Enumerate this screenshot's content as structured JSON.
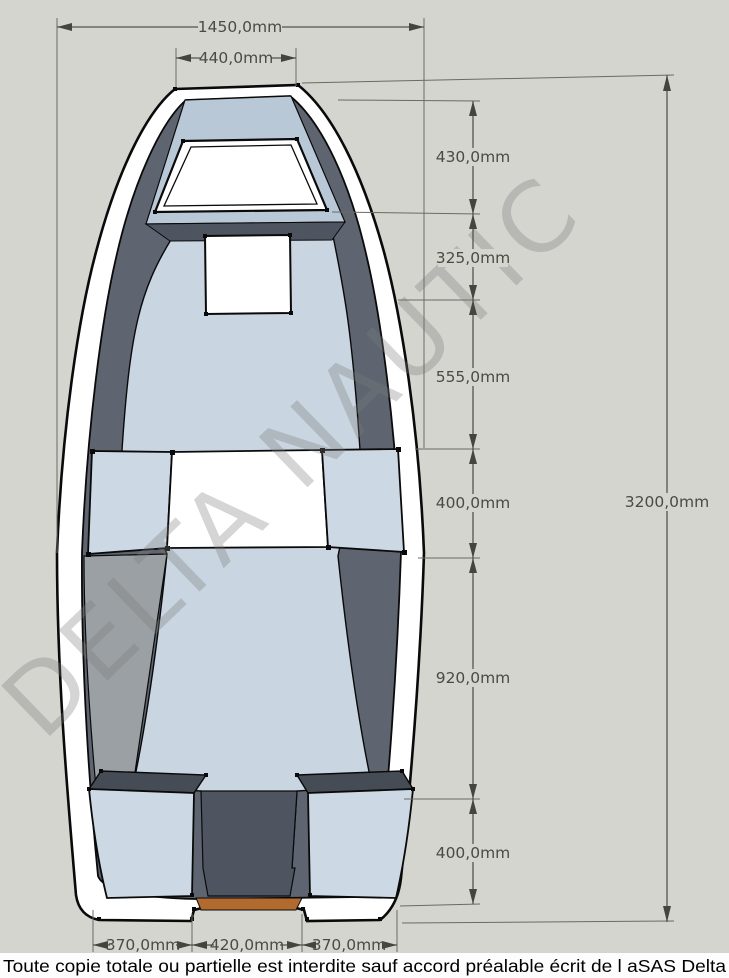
{
  "watermark": {
    "text": "DELTA NAUTIC"
  },
  "dims": {
    "width_overall": "1450,0mm",
    "width_bow": "440,0mm",
    "right": [
      "430,0mm",
      "325,0mm",
      "555,0mm",
      "400,0mm",
      "920,0mm",
      "400,0mm"
    ],
    "length_overall": "3200,0mm",
    "bottom": [
      "370,0mm",
      "420,0mm",
      "370,0mm"
    ]
  },
  "footer": {
    "text": "Toute copie totale ou partielle est interdite sauf accord préalable écrit de l aSAS Delta"
  },
  "colors": {
    "background": "#d5d5d0",
    "hull_white": "#ffffff",
    "inner_wall_dark": "#5e6570",
    "inner_wall_light": "#9ba0a4",
    "floor_blue": "#c9d5e1",
    "bow_deck_blue": "#b9c8d7",
    "deck_edge_dark": "#4e5560",
    "bench_blue": "#ccd8e3",
    "transom_orange": "#b26a2e",
    "dimension_lines": "#55554e",
    "dimension_text": "#4b4b44",
    "outline_black": "#0a0a0a",
    "footer_bg": "#fdfdfd"
  }
}
